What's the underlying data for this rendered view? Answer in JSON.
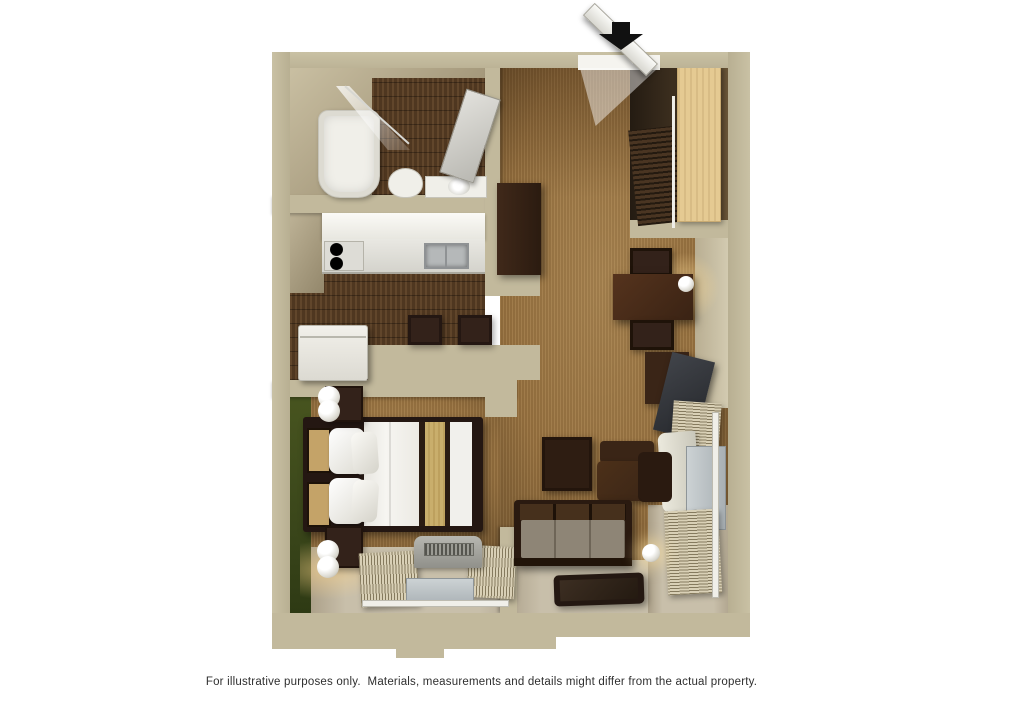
{
  "caption": {
    "text": "For illustrative purposes only.  Materials, measurements and details might differ from the actual property."
  },
  "icons": {
    "entrance_arrow": "entrance-direction-arrow"
  },
  "palette": {
    "page_background": "#ffffff",
    "wall_tan": "#c2b99c",
    "carpet_brown": "#97713f",
    "wood_floor_dark": "#4f3720",
    "accent_wall_green": "#424e1e",
    "closet_door_wood": "#e5ca92",
    "bedding_white": "#f4f3ef",
    "bedding_tan_stripe": "#c9ae6c",
    "furniture_espresso": "#33221a",
    "sofa_cushion_gray": "#8e8576",
    "vinyl_floor_beige": "#c8bfaa",
    "fixture_white": "#f0efe9",
    "window_glass": "#c3c9cc",
    "arrow_black": "#111111",
    "caption_text": "#2f2f2f"
  }
}
